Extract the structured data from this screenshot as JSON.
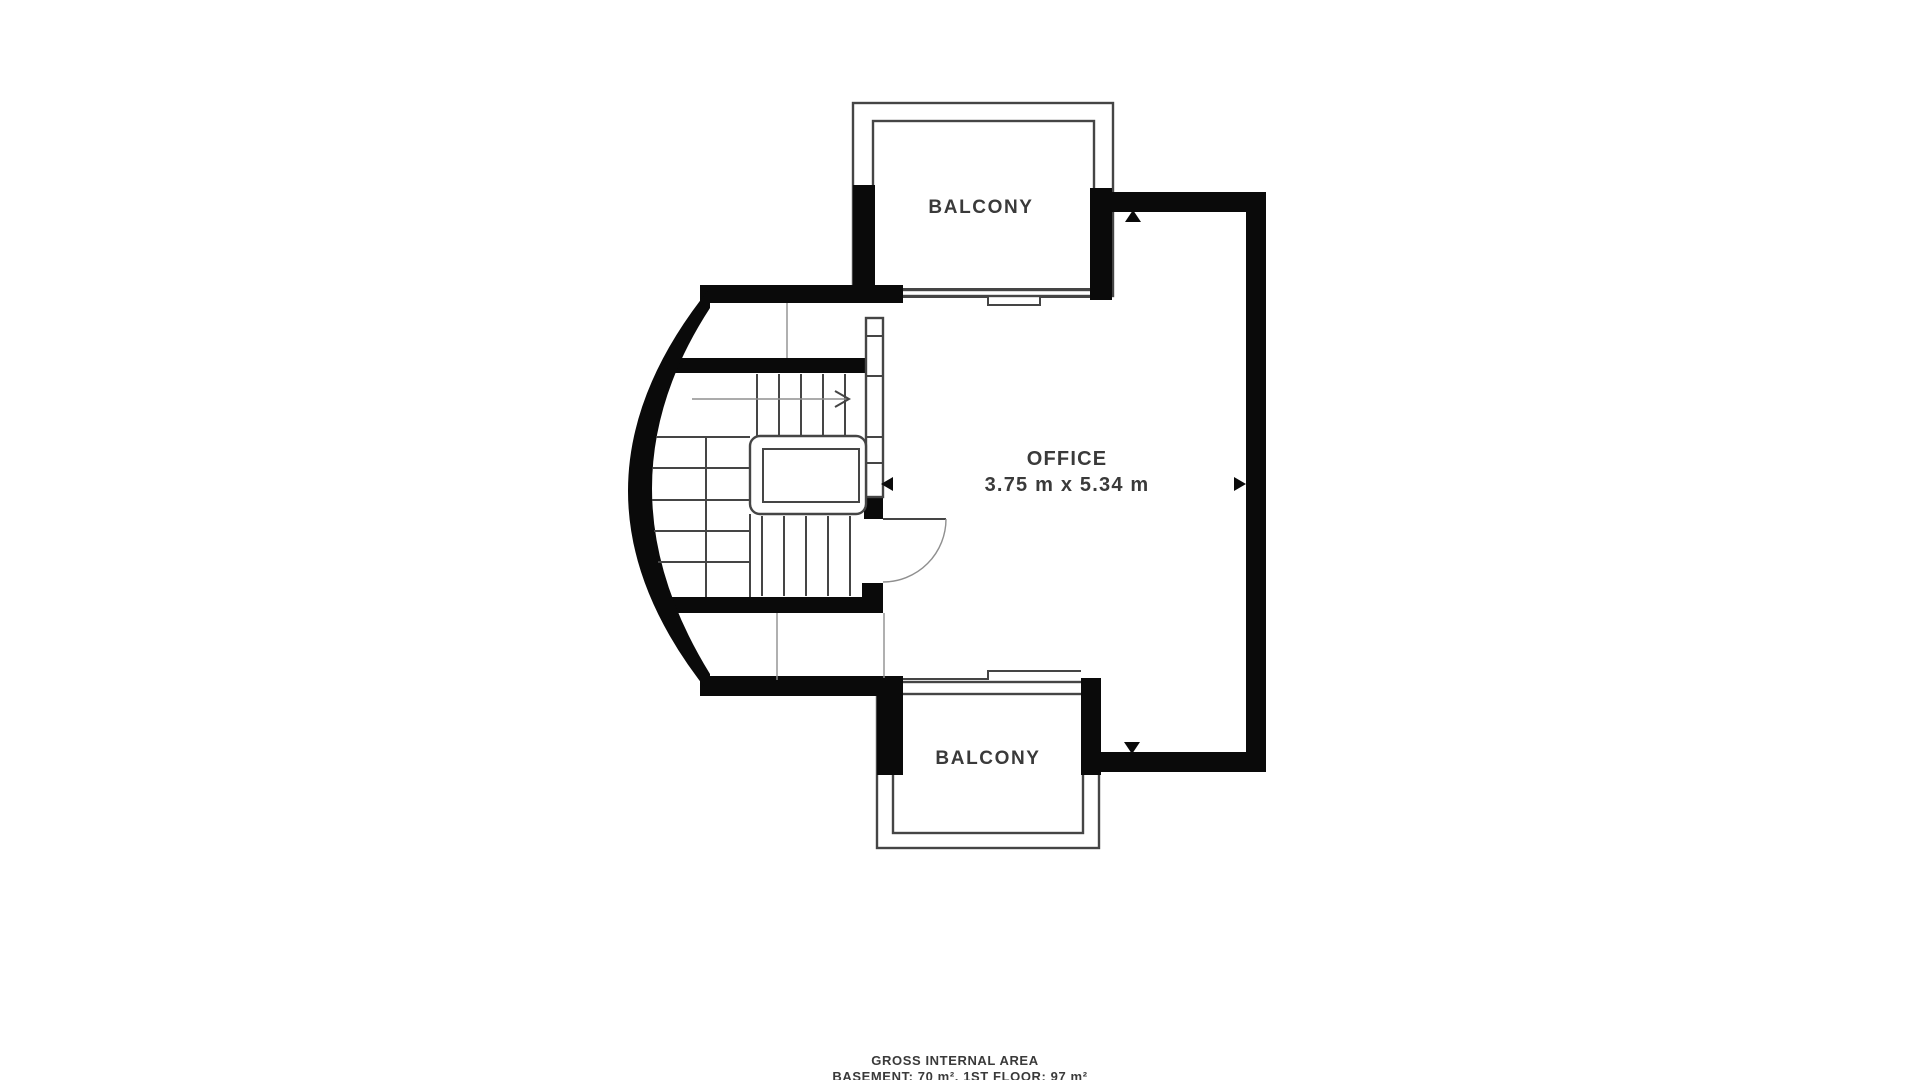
{
  "plan": {
    "labels": {
      "balcony_top": "BALCONY",
      "office": "OFFICE",
      "office_dimensions": "3.75 m x 5.34 m",
      "balcony_bottom": "BALCONY"
    },
    "footer": {
      "line1": "GROSS INTERNAL AREA",
      "line2": "BASEMENT: 70 m², 1ST FLOOR: 97 m²"
    },
    "icons": {
      "dimension_arrows": [
        "up",
        "down",
        "left",
        "right"
      ],
      "stair_direction_arrow": "right"
    }
  },
  "colors": {
    "wall": "#0a0a0a",
    "line": "#454545",
    "light_line": "#8f8f8f",
    "text": "#3a3a3a",
    "background": "#ffffff"
  }
}
